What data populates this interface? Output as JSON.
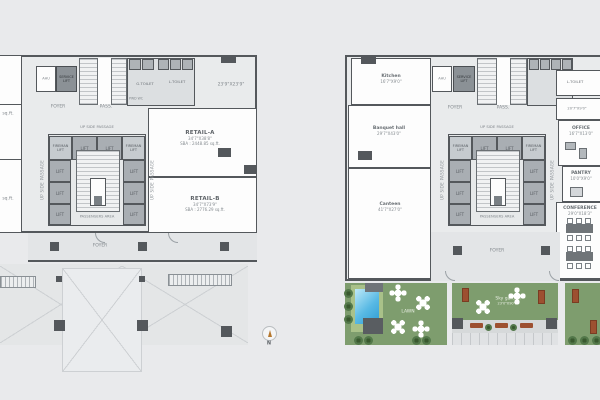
{
  "common": {
    "foyer": "FOYER",
    "pass": "PASS.",
    "up_side_passage": "UP SIDE PASSAGE",
    "passengers_area": "PASSENGERS AREA",
    "service_lift": "SERVICE LIFT",
    "ahu": "AHU",
    "lift": "LIFT",
    "fireman_lift": "FIREMAN LIFT",
    "g_toilet": "G.TOILET",
    "l_toilet": "L.TOILET",
    "pwd_wc": "PWD WC"
  },
  "left_plan": {
    "retail_a": {
      "name": "RETAIL-A",
      "dim": "34'7\"X38'8\"",
      "area": "SBA : 2448.85 sq.ft."
    },
    "retail_b": {
      "name": "RETAIL-B",
      "dim": "34'7\"X73'9\"",
      "area": "SBA : 2776.29 sq.ft."
    },
    "entry_dim": "23'9\"X23'9\"",
    "left_room_top_area": "sq.ft.",
    "left_room_bottom_area": "sq.ft.",
    "compass_n": "N"
  },
  "right_plan": {
    "kitchen": {
      "name": "Kitchen",
      "dim": "16'7\"X9'0\""
    },
    "banquet": {
      "name": "Banquet hall",
      "dim": "29'7\"X43'0\""
    },
    "canteen": {
      "name": "Canteen",
      "dim": "41'7\"X27'0\""
    },
    "store_dim": "20'7\"X9'0\"",
    "office": {
      "name": "OFFICE",
      "dim": "16'7\"X13'0\""
    },
    "pantry": {
      "name": "PANTRY",
      "dim": "10'0\"X9'0\""
    },
    "conference": {
      "name": "CONFERENCE",
      "dim": "29'0\"X18'3\""
    },
    "garden": {
      "lawn": "LAWN",
      "sky_garden": {
        "name": "Sky garden",
        "dim": "23'0\"X90'0\""
      }
    }
  }
}
